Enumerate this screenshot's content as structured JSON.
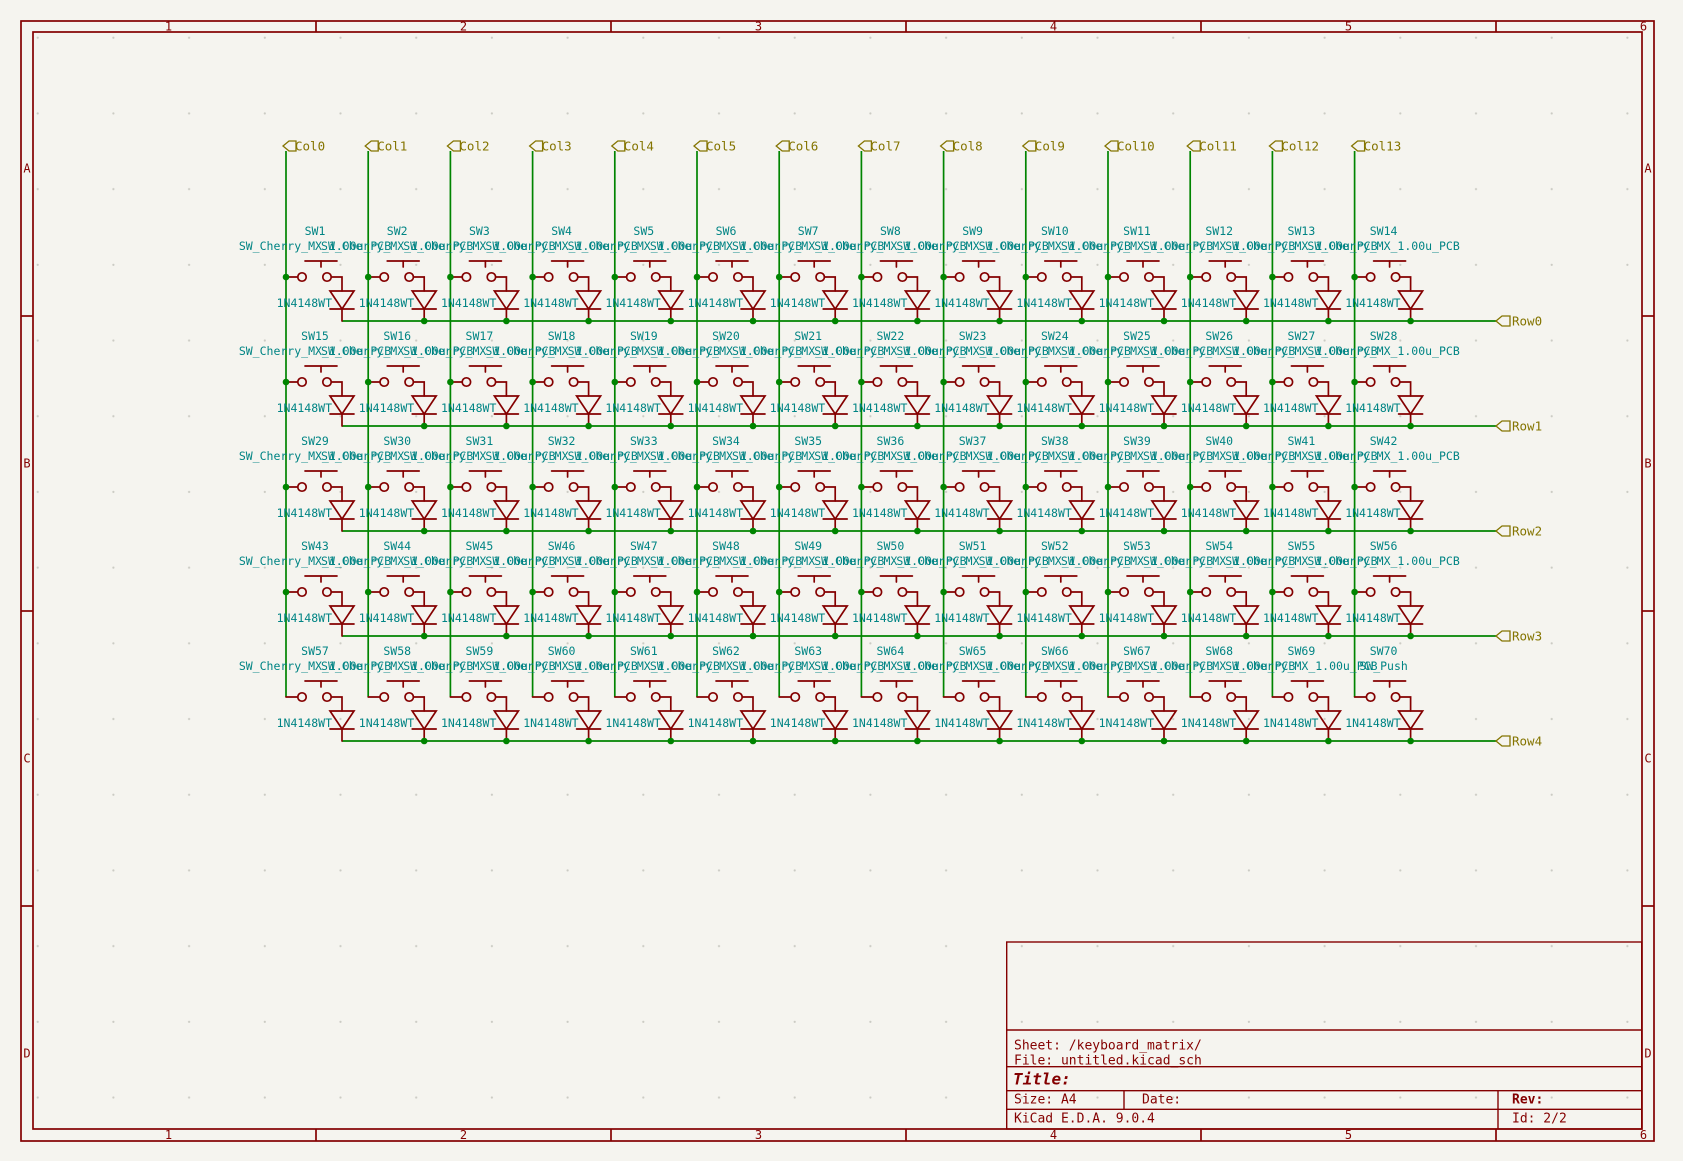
{
  "app": {
    "name": "KiCad Schematic Sheet"
  },
  "colors": {
    "background": "#F5F4EF",
    "frame": "#840000",
    "wire": "#008400",
    "component": "#840000",
    "reference_text": "#008484",
    "hier_label": "#847400",
    "grid_dot": "#BDBDB5"
  },
  "frame": {
    "top_numbers": [
      "1",
      "2",
      "3",
      "4",
      "5",
      "6"
    ],
    "bottom_numbers": [
      "1",
      "2",
      "3",
      "4",
      "5",
      "6"
    ],
    "left_letters": [
      "A",
      "B",
      "C",
      "D"
    ],
    "right_letters": [
      "A",
      "B",
      "C",
      "D"
    ]
  },
  "columns": [
    "Col0",
    "Col1",
    "Col2",
    "Col3",
    "Col4",
    "Col5",
    "Col6",
    "Col7",
    "Col8",
    "Col9",
    "Col10",
    "Col11",
    "Col12",
    "Col13"
  ],
  "rows": [
    "Row0",
    "Row1",
    "Row2",
    "Row3",
    "Row4"
  ],
  "diode_value": "1N4148WT",
  "switches": [
    {
      "ref": "SW1",
      "value": "SW_Cherry_MX_1.00u_PCB"
    },
    {
      "ref": "SW2",
      "value": "SW_Cherry_MX_1.00u_PCB"
    },
    {
      "ref": "SW3",
      "value": "SW_Cherry_MX_1.00u_PCB"
    },
    {
      "ref": "SW4",
      "value": "SW_Cherry_MX_1.00u_PCB"
    },
    {
      "ref": "SW5",
      "value": "SW_Cherry_MX_1.00u_PCB"
    },
    {
      "ref": "SW6",
      "value": "SW_Cherry_MX_1.00u_PCB"
    },
    {
      "ref": "SW7",
      "value": "SW_Cherry_MX_1.00u_PCB"
    },
    {
      "ref": "SW8",
      "value": "SW_Cherry_MX_1.00u_PCB"
    },
    {
      "ref": "SW9",
      "value": "SW_Cherry_MX_1.00u_PCB"
    },
    {
      "ref": "SW10",
      "value": "SW_Cherry_MX_1.00u_PCB"
    },
    {
      "ref": "SW11",
      "value": "SW_Cherry_MX_1.00u_PCB"
    },
    {
      "ref": "SW12",
      "value": "SW_Cherry_MX_1.00u_PCB"
    },
    {
      "ref": "SW13",
      "value": "SW_Cherry_MX_1.00u_PCB"
    },
    {
      "ref": "SW14",
      "value": "SW_Cherry_MX_1.00u_PCB"
    },
    {
      "ref": "SW15",
      "value": "SW_Cherry_MX_1.00u_PCB"
    },
    {
      "ref": "SW16",
      "value": "SW_Cherry_MX_1.00u_PCB"
    },
    {
      "ref": "SW17",
      "value": "SW_Cherry_MX_1.00u_PCB"
    },
    {
      "ref": "SW18",
      "value": "SW_Cherry_MX_1.00u_PCB"
    },
    {
      "ref": "SW19",
      "value": "SW_Cherry_MX_1.00u_PCB"
    },
    {
      "ref": "SW20",
      "value": "SW_Cherry_MX_1.00u_PCB"
    },
    {
      "ref": "SW21",
      "value": "SW_Cherry_MX_1.00u_PCB"
    },
    {
      "ref": "SW22",
      "value": "SW_Cherry_MX_1.00u_PCB"
    },
    {
      "ref": "SW23",
      "value": "SW_Cherry_MX_1.00u_PCB"
    },
    {
      "ref": "SW24",
      "value": "SW_Cherry_MX_1.00u_PCB"
    },
    {
      "ref": "SW25",
      "value": "SW_Cherry_MX_1.00u_PCB"
    },
    {
      "ref": "SW26",
      "value": "SW_Cherry_MX_1.00u_PCB"
    },
    {
      "ref": "SW27",
      "value": "SW_Cherry_MX_1.00u_PCB"
    },
    {
      "ref": "SW28",
      "value": "SW_Cherry_MX_1.00u_PCB"
    },
    {
      "ref": "SW29",
      "value": "SW_Cherry_MX_1.00u_PCB"
    },
    {
      "ref": "SW30",
      "value": "SW_Cherry_MX_1.00u_PCB"
    },
    {
      "ref": "SW31",
      "value": "SW_Cherry_MX_1.00u_PCB"
    },
    {
      "ref": "SW32",
      "value": "SW_Cherry_MX_1.00u_PCB"
    },
    {
      "ref": "SW33",
      "value": "SW_Cherry_MX_1.00u_PCB"
    },
    {
      "ref": "SW34",
      "value": "SW_Cherry_MX_1.00u_PCB"
    },
    {
      "ref": "SW35",
      "value": "SW_Cherry_MX_1.00u_PCB"
    },
    {
      "ref": "SW36",
      "value": "SW_Cherry_MX_1.00u_PCB"
    },
    {
      "ref": "SW37",
      "value": "SW_Cherry_MX_1.00u_PCB"
    },
    {
      "ref": "SW38",
      "value": "SW_Cherry_MX_1.00u_PCB"
    },
    {
      "ref": "SW39",
      "value": "SW_Cherry_MX_1.00u_PCB"
    },
    {
      "ref": "SW40",
      "value": "SW_Cherry_MX_1.00u_PCB"
    },
    {
      "ref": "SW41",
      "value": "SW_Cherry_MX_1.00u_PCB"
    },
    {
      "ref": "SW42",
      "value": "SW_Cherry_MX_1.00u_PCB"
    },
    {
      "ref": "SW43",
      "value": "SW_Cherry_MX_1.00u_PCB"
    },
    {
      "ref": "SW44",
      "value": "SW_Cherry_MX_1.00u_PCB"
    },
    {
      "ref": "SW45",
      "value": "SW_Cherry_MX_1.00u_PCB"
    },
    {
      "ref": "SW46",
      "value": "SW_Cherry_MX_1.00u_PCB"
    },
    {
      "ref": "SW47",
      "value": "SW_Cherry_MX_1.00u_PCB"
    },
    {
      "ref": "SW48",
      "value": "SW_Cherry_MX_1.00u_PCB"
    },
    {
      "ref": "SW49",
      "value": "SW_Cherry_MX_1.00u_PCB"
    },
    {
      "ref": "SW50",
      "value": "SW_Cherry_MX_1.00u_PCB"
    },
    {
      "ref": "SW51",
      "value": "SW_Cherry_MX_1.00u_PCB"
    },
    {
      "ref": "SW52",
      "value": "SW_Cherry_MX_1.00u_PCB"
    },
    {
      "ref": "SW53",
      "value": "SW_Cherry_MX_1.00u_PCB"
    },
    {
      "ref": "SW54",
      "value": "SW_Cherry_MX_1.00u_PCB"
    },
    {
      "ref": "SW55",
      "value": "SW_Cherry_MX_1.00u_PCB"
    },
    {
      "ref": "SW56",
      "value": "SW_Cherry_MX_1.00u_PCB"
    },
    {
      "ref": "SW57",
      "value": "SW_Cherry_MX_1.00u_PCB"
    },
    {
      "ref": "SW58",
      "value": "SW_Cherry_MX_1.00u_PCB"
    },
    {
      "ref": "SW59",
      "value": "SW_Cherry_MX_1.00u_PCB"
    },
    {
      "ref": "SW60",
      "value": "SW_Cherry_MX_1.00u_PCB"
    },
    {
      "ref": "SW61",
      "value": "SW_Cherry_MX_1.00u_PCB"
    },
    {
      "ref": "SW62",
      "value": "SW_Cherry_MX_1.00u_PCB"
    },
    {
      "ref": "SW63",
      "value": "SW_Cherry_MX_1.00u_PCB"
    },
    {
      "ref": "SW64",
      "value": "SW_Cherry_MX_1.00u_PCB"
    },
    {
      "ref": "SW65",
      "value": "SW_Cherry_MX_1.00u_PCB"
    },
    {
      "ref": "SW66",
      "value": "SW_Cherry_MX_1.00u_PCB"
    },
    {
      "ref": "SW67",
      "value": "SW_Cherry_MX_1.00u_PCB"
    },
    {
      "ref": "SW68",
      "value": "SW_Cherry_MX_1.00u_PCB"
    },
    {
      "ref": "SW69",
      "value": "SW_Cherry_MX_1.00u_PCB"
    },
    {
      "ref": "SW70",
      "value": "SW_Push"
    }
  ],
  "title_block": {
    "sheet": "Sheet: /keyboard_matrix/",
    "file": "File: untitled.kicad_sch",
    "title_label": "Title:",
    "size": "Size: A4",
    "date": "Date:",
    "rev": "Rev:",
    "generator": "KiCad E.D.A. 9.0.4",
    "id": "Id: 2/2"
  }
}
